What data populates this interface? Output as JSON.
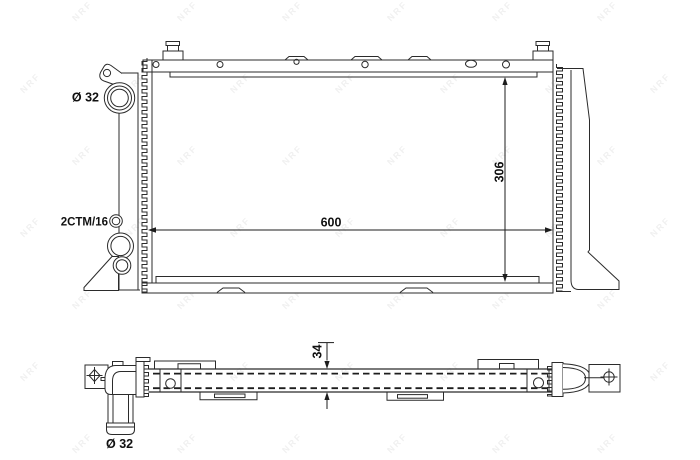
{
  "drawing": {
    "labels": {
      "upper_port_diameter": "Ø 32",
      "thread_code": "2CTM/16",
      "width_dim": "600",
      "height_dim": "306",
      "depth_dim": "34",
      "lower_port_diameter": "Ø 32"
    },
    "dimensions": {
      "width_mm": 600,
      "height_mm": 306,
      "depth_mm": 34,
      "port_diameter_mm": 32
    },
    "watermark": {
      "text": "NRF",
      "color": "rgba(40,40,40,0.07)"
    },
    "colors": {
      "line": "#2b2b2b",
      "background": "#ffffff"
    }
  }
}
